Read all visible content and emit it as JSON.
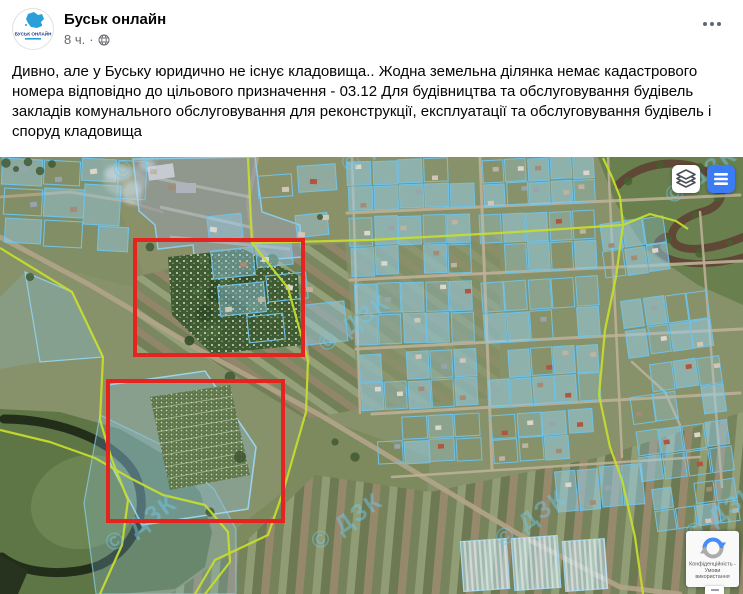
{
  "header": {
    "page_name": "Буськ онлайн",
    "timestamp": "8 ч.",
    "separator": "·",
    "icons": {
      "audience": "globe-icon",
      "more": "ellipsis-icon"
    }
  },
  "avatar": {
    "title": "БУСЬК ОНЛАЙН"
  },
  "post": {
    "text": "Дивно, але у Буську юридично не існує кладовища.. Жодна земельна ділянка немає кадастрового номера відповідно до цільового призначення - 03.12 Для будівництва та обслуговування будівель закладів комунального обслуговування для реконструкції, експлуатації та обслуговування будівель і споруд кладовища"
  },
  "map": {
    "watermark": "© ДЗК",
    "controls": {
      "layers": "layers-icon",
      "menu": "hamburger-icon"
    },
    "highlight_color": "#e52420",
    "highlights": [
      {
        "x": 133,
        "y": 81,
        "width": 172,
        "height": 119
      },
      {
        "x": 106,
        "y": 222,
        "width": 179,
        "height": 144
      }
    ],
    "recaptcha": {
      "line1": "Конфіденційність - Умови",
      "line2": "використання"
    },
    "colors": {
      "parcel_outline": "#6fc2e8",
      "parcel_fill": "rgba(152,208,238,0.5)",
      "boundary": "#c5dc2e",
      "menu_button": "#3b7cf5"
    }
  }
}
